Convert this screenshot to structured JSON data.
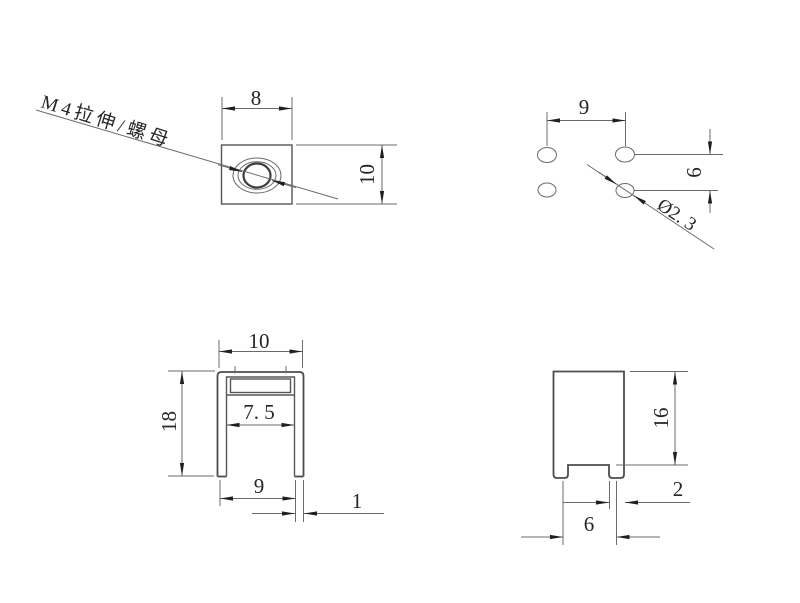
{
  "drawing": {
    "background_color": "#ffffff",
    "line_color": "#6b6b6b",
    "outline_color": "#4c4c4c",
    "text_color": "#262626",
    "views": {
      "top_view": {
        "callout": "M4拉伸/螺母",
        "width_dim": "8",
        "height_dim": "10"
      },
      "hole_pattern_view": {
        "hole_spacing_horizontal": "9",
        "hole_spacing_vertical": "6",
        "hole_diameter": "Ø2. 3"
      },
      "front_view": {
        "outer_width": "10",
        "height": "18",
        "inner_width": "7. 5",
        "leg_span": "9",
        "wall_thickness": "1"
      },
      "side_view": {
        "height": "16",
        "leg_width": "2",
        "leg_spacing": "6"
      }
    }
  }
}
